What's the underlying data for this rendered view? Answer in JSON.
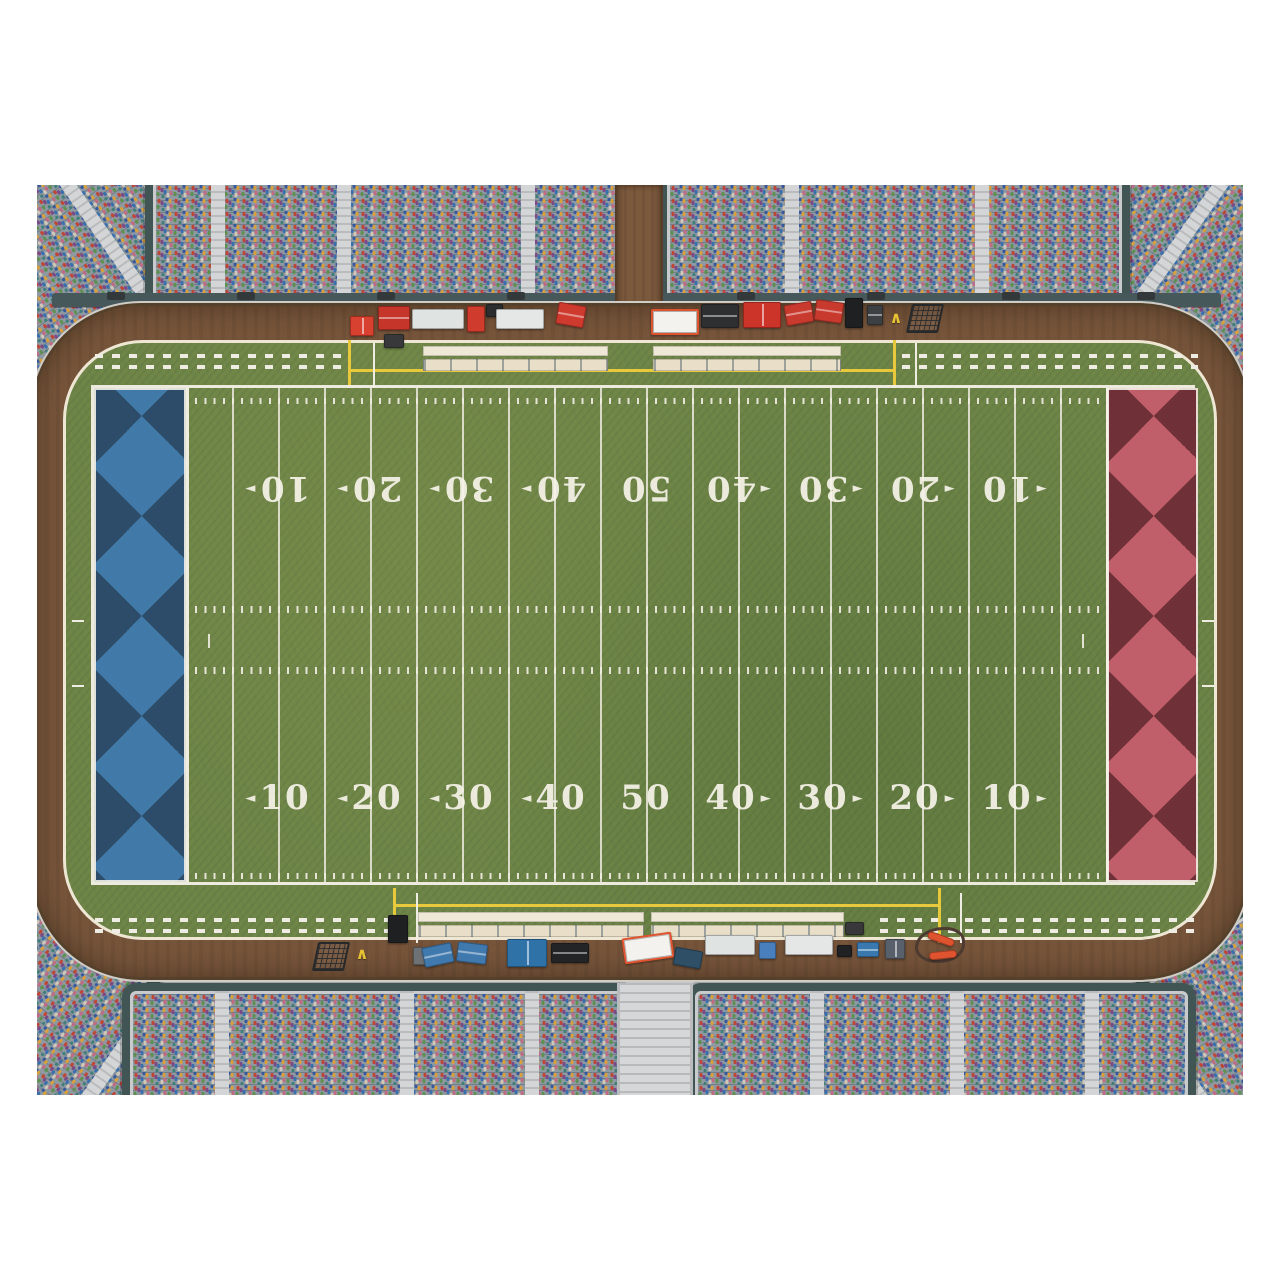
{
  "scene": {
    "type": "overhead-football-stadium-illustration",
    "background": "#ffffff"
  },
  "palette": {
    "grass": "#6d8449",
    "track_dirt": "#77553b",
    "concourse": "#c6c7c8",
    "stand_frame": "#415654",
    "wall": "#46585a",
    "line_white": "#eeebe0",
    "line_yellow": "#e7c93b",
    "bench_cream": "#efe6d2",
    "endzone_left_dark": "#2c4c69",
    "endzone_left_light": "#4179a8",
    "endzone_right_dark": "#6f3038",
    "endzone_right_light": "#c05f69"
  },
  "glyphs": {
    "chevron": "∧",
    "arrow_left": "◄",
    "arrow_right": "►"
  },
  "field": {
    "yard_line_interval_yards": 5,
    "yard_lines_px": {
      "start": 92,
      "step": 46,
      "count": 21
    },
    "numbers": [
      {
        "t": "10",
        "a": "left"
      },
      {
        "t": "20",
        "a": "left"
      },
      {
        "t": "30",
        "a": "left"
      },
      {
        "t": "40",
        "a": "left"
      },
      {
        "t": "50",
        "a": "none"
      },
      {
        "t": "40",
        "a": "right"
      },
      {
        "t": "30",
        "a": "right"
      },
      {
        "t": "20",
        "a": "right"
      },
      {
        "t": "10",
        "a": "right"
      }
    ],
    "number_rows": [
      {
        "y": 388,
        "flipped": false
      },
      {
        "y": 78,
        "flipped": true
      }
    ],
    "number_center_start": 184,
    "number_center_step": 92,
    "tick_rows": [
      {
        "x": 92,
        "y": 10,
        "w": 920,
        "h": 6
      },
      {
        "x": 92,
        "y": 218,
        "w": 920,
        "h": 7
      },
      {
        "x": 92,
        "y": 279,
        "w": 920,
        "h": 7
      },
      {
        "x": 92,
        "y": 485,
        "w": 920,
        "h": 6
      }
    ],
    "extra_marks": [
      {
        "x": 114,
        "y": 246,
        "w": 2,
        "h": 14
      },
      {
        "x": 988,
        "y": 246,
        "w": 2,
        "h": 14
      }
    ],
    "endzones": [
      {
        "name": "endzone-left",
        "x": 0,
        "w": 92,
        "dark": "#2c4c69",
        "light": "#4179a8"
      },
      {
        "name": "endzone-right",
        "x": 1012,
        "w": 92,
        "dark": "#6f3038",
        "light": "#c05f69"
      }
    ]
  },
  "aprons": {
    "dash_rows": [
      {
        "x": 55,
        "y": 166,
        "w": 253
      },
      {
        "x": 55,
        "y": 177,
        "w": 253
      },
      {
        "x": 862,
        "y": 166,
        "w": 296
      },
      {
        "x": 862,
        "y": 177,
        "w": 296
      },
      {
        "x": 55,
        "y": 730,
        "w": 296
      },
      {
        "x": 55,
        "y": 741,
        "w": 296
      },
      {
        "x": 840,
        "y": 730,
        "w": 318
      },
      {
        "x": 840,
        "y": 741,
        "w": 318
      }
    ],
    "lines": [
      {
        "x": 308,
        "y": 152,
        "w": 3,
        "h": 48,
        "c": "#e7c93b"
      },
      {
        "x": 853,
        "y": 152,
        "w": 3,
        "h": 48,
        "c": "#e7c93b"
      },
      {
        "x": 308,
        "y": 181,
        "w": 548,
        "h": 3,
        "c": "#e7c93b"
      },
      {
        "x": 333,
        "y": 155,
        "w": 2,
        "h": 45,
        "c": "#efede3"
      },
      {
        "x": 875,
        "y": 155,
        "w": 2,
        "h": 45,
        "c": "#efede3"
      },
      {
        "x": 353,
        "y": 700,
        "w": 3,
        "h": 55,
        "c": "#e7c93b"
      },
      {
        "x": 898,
        "y": 700,
        "w": 3,
        "h": 55,
        "c": "#e7c93b"
      },
      {
        "x": 353,
        "y": 716,
        "w": 548,
        "h": 3,
        "c": "#e7c93b"
      },
      {
        "x": 376,
        "y": 705,
        "w": 2,
        "h": 50,
        "c": "#efede3"
      },
      {
        "x": 920,
        "y": 705,
        "w": 2,
        "h": 50,
        "c": "#efede3"
      },
      {
        "x": 32,
        "y": 432,
        "w": 12,
        "h": 2,
        "c": "#efede3"
      },
      {
        "x": 32,
        "y": 497,
        "w": 12,
        "h": 2,
        "c": "#efede3"
      },
      {
        "x": 1162,
        "y": 432,
        "w": 12,
        "h": 2,
        "c": "#efede3"
      },
      {
        "x": 1162,
        "y": 497,
        "w": 12,
        "h": 2,
        "c": "#efede3"
      }
    ],
    "benches": [
      {
        "x": 383,
        "y": 158,
        "w": 185
      },
      {
        "x": 613,
        "y": 158,
        "w": 188
      },
      {
        "x": 378,
        "y": 724,
        "w": 226
      },
      {
        "x": 611,
        "y": 724,
        "w": 193
      }
    ]
  },
  "stands": {
    "blocks": [
      {
        "name": "stand-corner-top-left",
        "x": -110,
        "y": -90,
        "w": 320,
        "h": 230,
        "r": -35,
        "aisles": [
          150
        ]
      },
      {
        "name": "stand-corner-top-right",
        "x": 996,
        "y": -90,
        "w": 320,
        "h": 230,
        "r": 35,
        "aisles": [
          150
        ]
      },
      {
        "name": "stand-corner-bottom-left",
        "x": -110,
        "y": 780,
        "w": 320,
        "h": 240,
        "r": 35,
        "aisles": [
          150
        ]
      },
      {
        "name": "stand-corner-bottom-right",
        "x": 996,
        "y": 780,
        "w": 320,
        "h": 240,
        "r": -35,
        "aisles": [
          150
        ]
      },
      {
        "name": "stand-top-left",
        "x": 108,
        "y": -50,
        "w": 472,
        "h": 164,
        "r": 0,
        "aisles": [
          58,
          184,
          368
        ]
      },
      {
        "name": "stand-top-right",
        "x": 622,
        "y": -50,
        "w": 455,
        "h": 164,
        "r": 0,
        "aisles": [
          118,
          308
        ]
      },
      {
        "name": "stand-bottom-left",
        "x": 85,
        "y": 798,
        "w": 495,
        "h": 160,
        "r": 0,
        "aisles": [
          85,
          270,
          395
        ]
      },
      {
        "name": "stand-bottom-right",
        "x": 650,
        "y": 798,
        "w": 493,
        "h": 160,
        "r": 0,
        "aisles": [
          115,
          255,
          390
        ]
      }
    ],
    "stairs": {
      "x": 580,
      "y": 798,
      "w": 70,
      "h": 112
    },
    "walls": [
      {
        "x": 15,
        "y": 108,
        "w": 565,
        "h": 14
      },
      {
        "x": 622,
        "y": 108,
        "w": 562,
        "h": 14
      }
    ],
    "gates_top": [
      {
        "x": 70
      },
      {
        "x": 200
      },
      {
        "x": 340
      },
      {
        "x": 470
      },
      {
        "x": 700
      },
      {
        "x": 830
      },
      {
        "x": 965
      },
      {
        "x": 1100
      }
    ],
    "gate_top_y": 107,
    "gates_bottom": [
      {
        "x": 150
      },
      {
        "x": 300
      },
      {
        "x": 455
      },
      {
        "x": 612
      },
      {
        "x": 760
      },
      {
        "x": 915
      },
      {
        "x": 1060
      }
    ],
    "gate_bottom_y": 785,
    "path": {
      "x": 578,
      "y": 0,
      "w": 48,
      "h": 140
    }
  },
  "equipment": [
    {
      "n": "first-aid-cart",
      "x": 313,
      "y": 131,
      "w": 24,
      "h": 20,
      "c": "#d8402f",
      "d": "split"
    },
    {
      "n": "red-cabinet-cart",
      "x": 341,
      "y": 121,
      "w": 32,
      "h": 24,
      "c": "#c5352a",
      "d": "lid"
    },
    {
      "n": "beverage-table",
      "x": 375,
      "y": 124,
      "w": 52,
      "h": 20,
      "c": "#dfe3e2",
      "d": "cups"
    },
    {
      "n": "vending-machine",
      "x": 430,
      "y": 121,
      "w": 18,
      "h": 26,
      "c": "#cf3b2c"
    },
    {
      "n": "equipment-case",
      "x": 449,
      "y": 119,
      "w": 17,
      "h": 13,
      "c": "#2c2d2f"
    },
    {
      "n": "beverage-table",
      "x": 459,
      "y": 124,
      "w": 48,
      "h": 20,
      "c": "#e4e7e5",
      "d": "cups"
    },
    {
      "n": "red-trunk",
      "x": 520,
      "y": 119,
      "w": 28,
      "h": 22,
      "c": "#cf3a2e",
      "r": 10,
      "d": "lid"
    },
    {
      "n": "grill",
      "x": 347,
      "y": 149,
      "w": 20,
      "h": 14,
      "c": "#38383a",
      "d": "coals"
    },
    {
      "n": "stretcher",
      "x": 614,
      "y": 124,
      "w": 44,
      "h": 22,
      "c": "#f4f2ee",
      "bd": "#e0532f",
      "d": "slats"
    },
    {
      "n": "canopy-table",
      "x": 664,
      "y": 119,
      "w": 38,
      "h": 24,
      "c": "#2e2f31",
      "d": "lid"
    },
    {
      "n": "double-cart-red",
      "x": 706,
      "y": 117,
      "w": 38,
      "h": 26,
      "c": "#cc3429",
      "d": "split"
    },
    {
      "n": "red-trunk",
      "x": 748,
      "y": 118,
      "w": 28,
      "h": 21,
      "c": "#c93a2e",
      "r": -10,
      "d": "lid"
    },
    {
      "n": "red-trunk",
      "x": 778,
      "y": 116,
      "w": 28,
      "h": 21,
      "c": "#c93a2e",
      "r": 8,
      "d": "lid"
    },
    {
      "n": "ball-cart",
      "x": 808,
      "y": 113,
      "w": 18,
      "h": 30,
      "c": "#1f2022",
      "d": "balls"
    },
    {
      "n": "hand-truck",
      "x": 830,
      "y": 120,
      "w": 16,
      "h": 20,
      "c": "#3c4043",
      "d": "lid"
    },
    {
      "n": "chevron-marker",
      "x": 850,
      "y": 126,
      "w": 18,
      "h": 12,
      "d": "chevron"
    },
    {
      "n": "kicking-net",
      "x": 872,
      "y": 119,
      "w": 28,
      "h": 25,
      "d": "mesh"
    },
    {
      "n": "kicking-net",
      "x": 278,
      "y": 757,
      "w": 28,
      "h": 25,
      "d": "mesh"
    },
    {
      "n": "chevron-marker",
      "x": 316,
      "y": 762,
      "w": 18,
      "h": 12,
      "d": "chevron"
    },
    {
      "n": "ball-cart",
      "x": 351,
      "y": 730,
      "w": 20,
      "h": 28,
      "c": "#1f2022",
      "d": "balls"
    },
    {
      "n": "utility-cart",
      "x": 376,
      "y": 762,
      "w": 24,
      "h": 18,
      "c": "#6e7274",
      "d": "split"
    },
    {
      "n": "blue-trunk",
      "x": 386,
      "y": 760,
      "w": 30,
      "h": 20,
      "c": "#4079ae",
      "r": -12,
      "d": "lid"
    },
    {
      "n": "blue-trunk",
      "x": 420,
      "y": 758,
      "w": 30,
      "h": 20,
      "c": "#4079ae",
      "r": 7,
      "d": "lid"
    },
    {
      "n": "double-cooler",
      "x": 470,
      "y": 754,
      "w": 40,
      "h": 28,
      "c": "#2f72a8",
      "d": "split"
    },
    {
      "n": "equipment-boat",
      "x": 514,
      "y": 758,
      "w": 38,
      "h": 20,
      "c": "#232426",
      "d": "lid"
    },
    {
      "n": "stretcher",
      "x": 586,
      "y": 750,
      "w": 46,
      "h": 22,
      "c": "#f4f2ee",
      "bd": "#e0532f",
      "r": -8,
      "d": "slats"
    },
    {
      "n": "tray-cart",
      "x": 637,
      "y": 764,
      "w": 28,
      "h": 18,
      "c": "#2e4f66",
      "r": 10,
      "d": "cups"
    },
    {
      "n": "beverage-table",
      "x": 668,
      "y": 750,
      "w": 50,
      "h": 20,
      "c": "#dfe3e2",
      "d": "cups"
    },
    {
      "n": "blue-crate",
      "x": 722,
      "y": 757,
      "w": 17,
      "h": 17,
      "c": "#4a7fbd"
    },
    {
      "n": "beverage-table",
      "x": 748,
      "y": 750,
      "w": 48,
      "h": 20,
      "c": "#e4e7e5",
      "d": "cups"
    },
    {
      "n": "equipment-case",
      "x": 800,
      "y": 760,
      "w": 15,
      "h": 12,
      "c": "#202123"
    },
    {
      "n": "cooler",
      "x": 820,
      "y": 757,
      "w": 22,
      "h": 15,
      "c": "#3a79b0",
      "d": "lid"
    },
    {
      "n": "medical-kit",
      "x": 848,
      "y": 754,
      "w": 20,
      "h": 20,
      "c": "#58616b",
      "d": "split"
    },
    {
      "n": "grill",
      "x": 808,
      "y": 737,
      "w": 19,
      "h": 13,
      "c": "#38383a",
      "d": "coals"
    },
    {
      "n": "chain-cable",
      "x": 878,
      "y": 742,
      "w": 44,
      "h": 30,
      "d": "cable"
    },
    {
      "n": "down-marker",
      "x": 890,
      "y": 750,
      "w": 28,
      "h": 8,
      "c": "#e0532f",
      "r": 20,
      "d": "pole"
    },
    {
      "n": "down-marker",
      "x": 892,
      "y": 766,
      "w": 28,
      "h": 8,
      "c": "#e0532f",
      "r": -6,
      "d": "pole"
    }
  ]
}
